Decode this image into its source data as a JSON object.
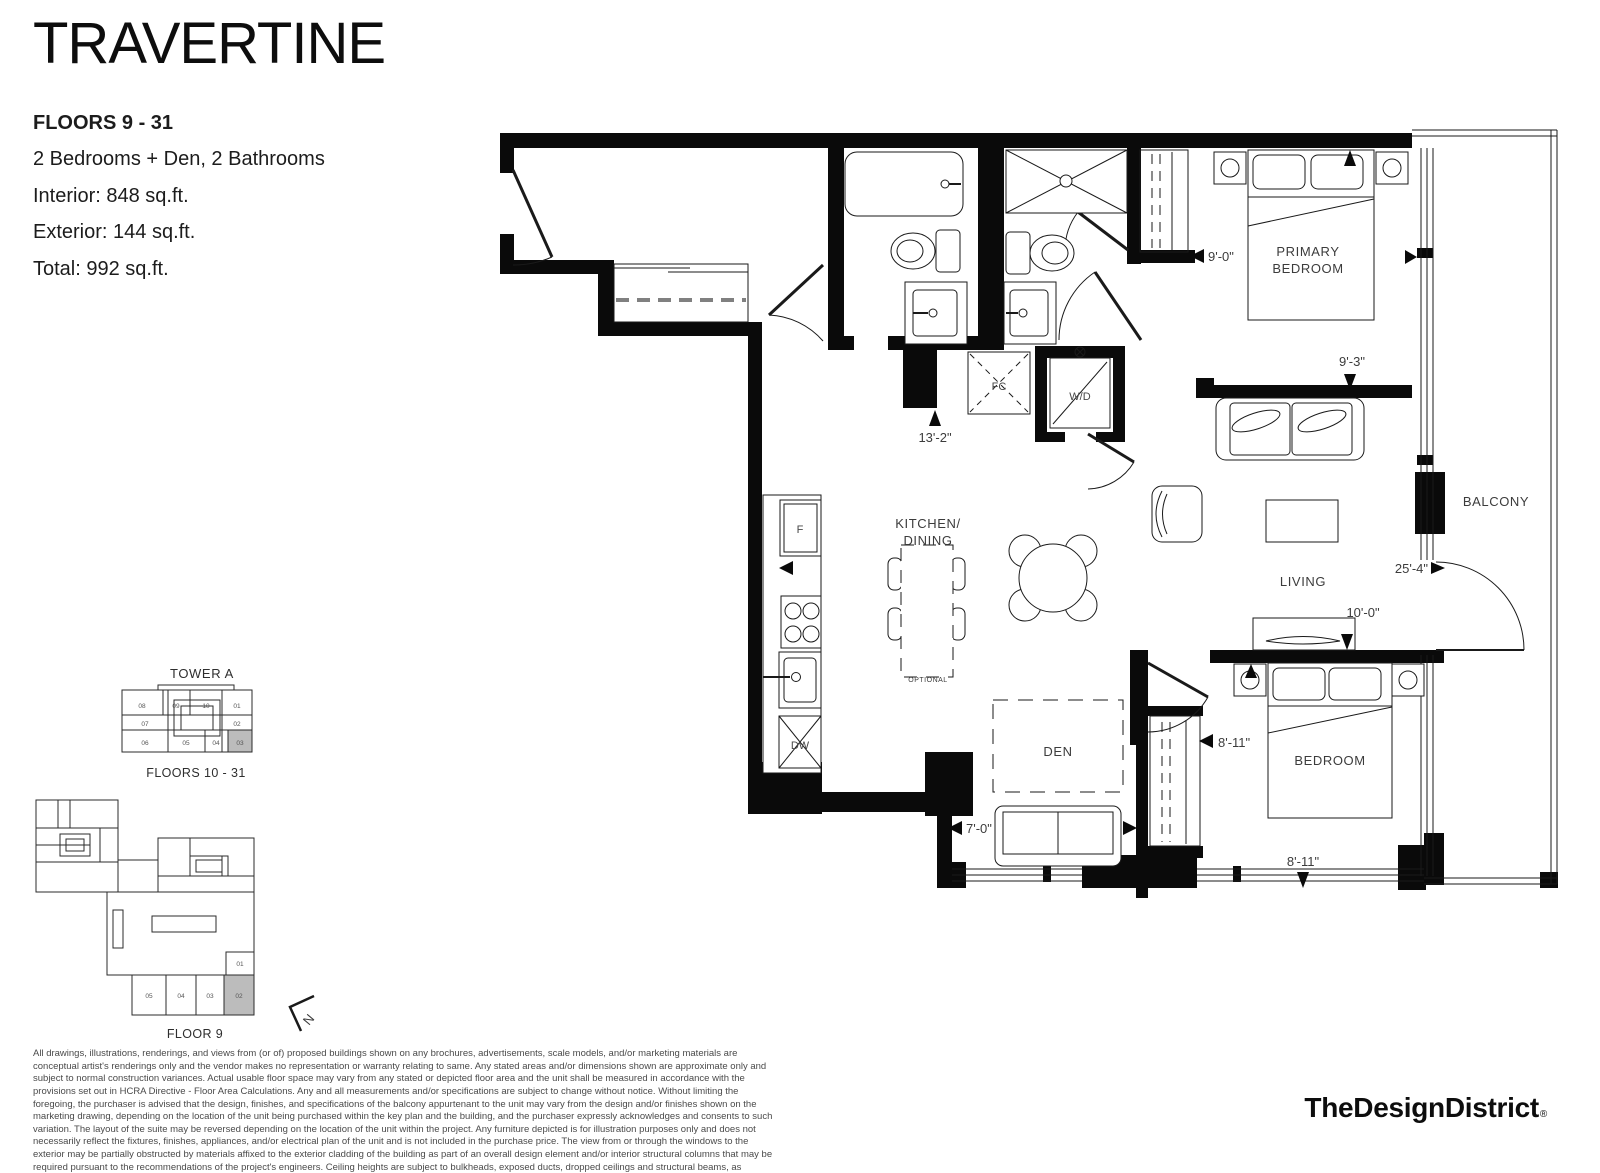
{
  "header": {
    "title": "TRAVERTINE",
    "floors": "FLOORS 9 - 31",
    "config": "2 Bedrooms + Den, 2 Bathrooms",
    "interior": "Interior: 848 sq.ft.",
    "exterior": "Exterior: 144 sq.ft.",
    "total": "Total: 992 sq.ft."
  },
  "floorplan": {
    "room_labels": {
      "primary_bedroom_1": "PRIMARY",
      "primary_bedroom_2": "BEDROOM",
      "bedroom": "BEDROOM",
      "living": "LIVING",
      "den": "DEN",
      "balcony": "BALCONY",
      "kitchen_1": "KITCHEN/",
      "kitchen_2": "DINING",
      "optional": "OPTIONAL"
    },
    "fixture_labels": {
      "fridge": "F",
      "dishwasher": "DW",
      "washer_dryer": "W/D",
      "fan_coil": "FC"
    },
    "dimensions": {
      "entry_hall": "13'-2\"",
      "primary_closet": "9'-0\"",
      "primary_width": "9'-3\"",
      "living_length": "25'-4\"",
      "living_width": "10'-0\"",
      "den_width": "7'-0\"",
      "bedroom_width": "8'-11\"",
      "bedroom_length": "8'-11\""
    }
  },
  "keyplans": {
    "tower_a": {
      "title": "TOWER A",
      "caption": "FLOORS 10 - 31",
      "highlighted_unit": "03",
      "units": {
        "u08": "08",
        "u09": "09",
        "u10": "10",
        "u01": "01",
        "u07": "07",
        "u02": "02",
        "u06": "06",
        "u05": "05",
        "u04": "04",
        "u03": "03"
      }
    },
    "floor_9": {
      "caption": "FLOOR 9",
      "highlighted_unit": "02",
      "units": {
        "u05": "05",
        "u04": "04",
        "u03": "03",
        "u02": "02",
        "u01": "01"
      }
    },
    "north_label": "N"
  },
  "footer": {
    "disclaimer": "All drawings, illustrations, renderings, and views from (or of) proposed buildings shown on any brochures, advertisements, scale models, and/or marketing materials are conceptual artist's renderings only and the vendor makes no representation or warranty relating to same. Any stated areas and/or dimensions shown are approximate only and subject to normal construction variances. Actual usable floor space may vary from any stated or depicted floor area and the unit shall be measured in accordance with the provisions set out in HCRA Directive - Floor Area Calculations. Any and all measurements and/or specifications are subject to change without notice. Without limiting the foregoing, the purchaser is advised that the design, finishes, and specifications of the balcony appurtenant to the unit may vary from the design and/or finishes shown on the marketing drawing, depending on the location of the unit being purchased within the key plan and the building, and the purchaser expressly acknowledges and consents to such variation. The layout of the suite may be reversed depending on the location of the unit within the project. Any furniture depicted is for illustration purposes only and does not necessarily reflect the fixtures, finishes, appliances, and/or electrical plan of the unit and is not included in the purchase price. The view from or through the windows to the exterior may be partially obstructed by materials affixed to the exterior cladding of the building as part of an overall design element and/or interior structural columns that may be required pursuant to the recommendations of the project's engineers. Ceiling heights are subject to bulkheads, exposed ducts, dropped ceilings and structural beams, as applicable pursuant to the plans. All features and finishes are subject to change without notice. E.&O.E. July, 2022.",
    "logo": "TheDesignDistrict",
    "registered": "®"
  },
  "colors": {
    "wall": "#0a0a0a",
    "highlight": "#bcbcbc",
    "muted_text": "#4a4a4a"
  }
}
